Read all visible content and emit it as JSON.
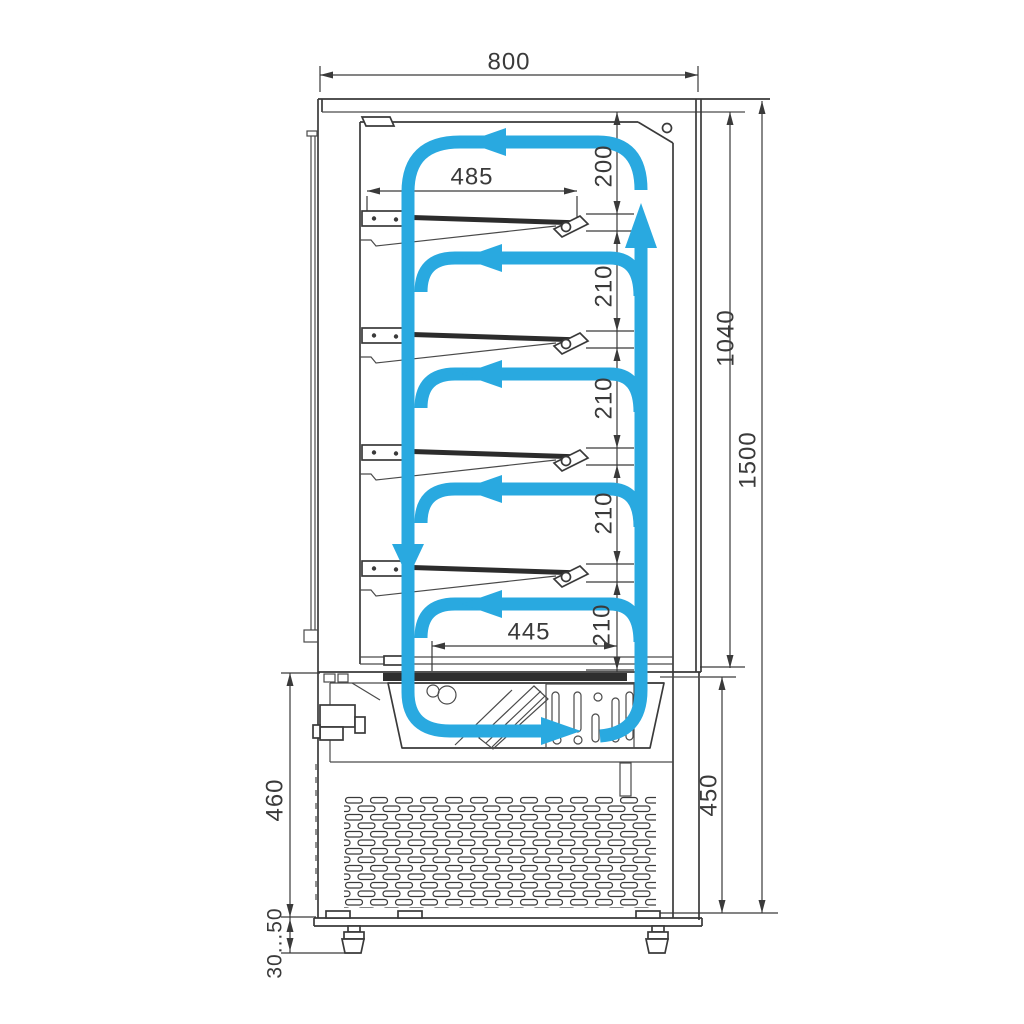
{
  "colors": {
    "airflow": "#29A9E0",
    "line": "#3a3a3a"
  },
  "dims": {
    "width_top": "800",
    "shelf_span": "485",
    "top_gap": "200",
    "gaps": [
      "210",
      "210",
      "210",
      "210"
    ],
    "inner_height": "1040",
    "total_height": "1500",
    "bottom_span": "445",
    "base_height_left": "460",
    "base_height_right": "450",
    "feet_range": "30...50"
  }
}
